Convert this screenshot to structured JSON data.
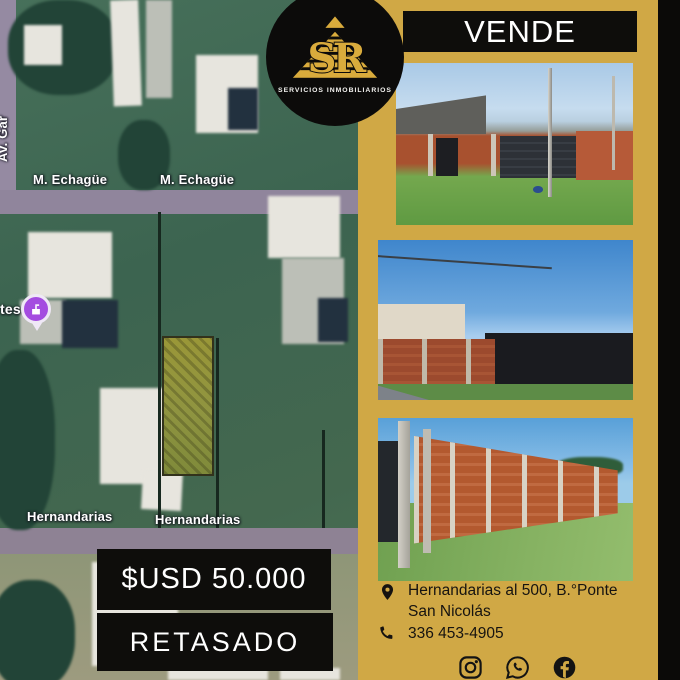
{
  "palette": {
    "background_gold": "#d0a845",
    "banner_black": "#0e0d0b",
    "text_white": "#ffffff",
    "contact_text": "#161310",
    "logo_gold": "#d9ab3c",
    "poi_purple": "#a44ce0",
    "brick_orange": "#a8512f",
    "grass_green": "#6fa050",
    "sky_blue": "#6fa8dc"
  },
  "logo": {
    "initials": "SR",
    "subtitle": "SERVICIOS INMOBILIARIOS",
    "icon": "stepped-pyramid-icon"
  },
  "header": {
    "action_label": "VENDE"
  },
  "map": {
    "street_top_label": "M. Echagüe",
    "street_bottom_label": "Hernandarias",
    "side_street_label_partial": "Av. Gar",
    "poi_label_partial": "tes",
    "poi_icon": "building-pin-icon"
  },
  "pricing": {
    "price_label": "$USD 50.000",
    "status_label": "RETASADO"
  },
  "contact": {
    "address_line1": "Hernandarias al 500, B.°Ponte",
    "address_line2": "San Nicolás",
    "phone": "336 453-4905"
  },
  "social": {
    "icons": [
      "instagram-icon",
      "whatsapp-icon",
      "facebook-icon"
    ]
  }
}
